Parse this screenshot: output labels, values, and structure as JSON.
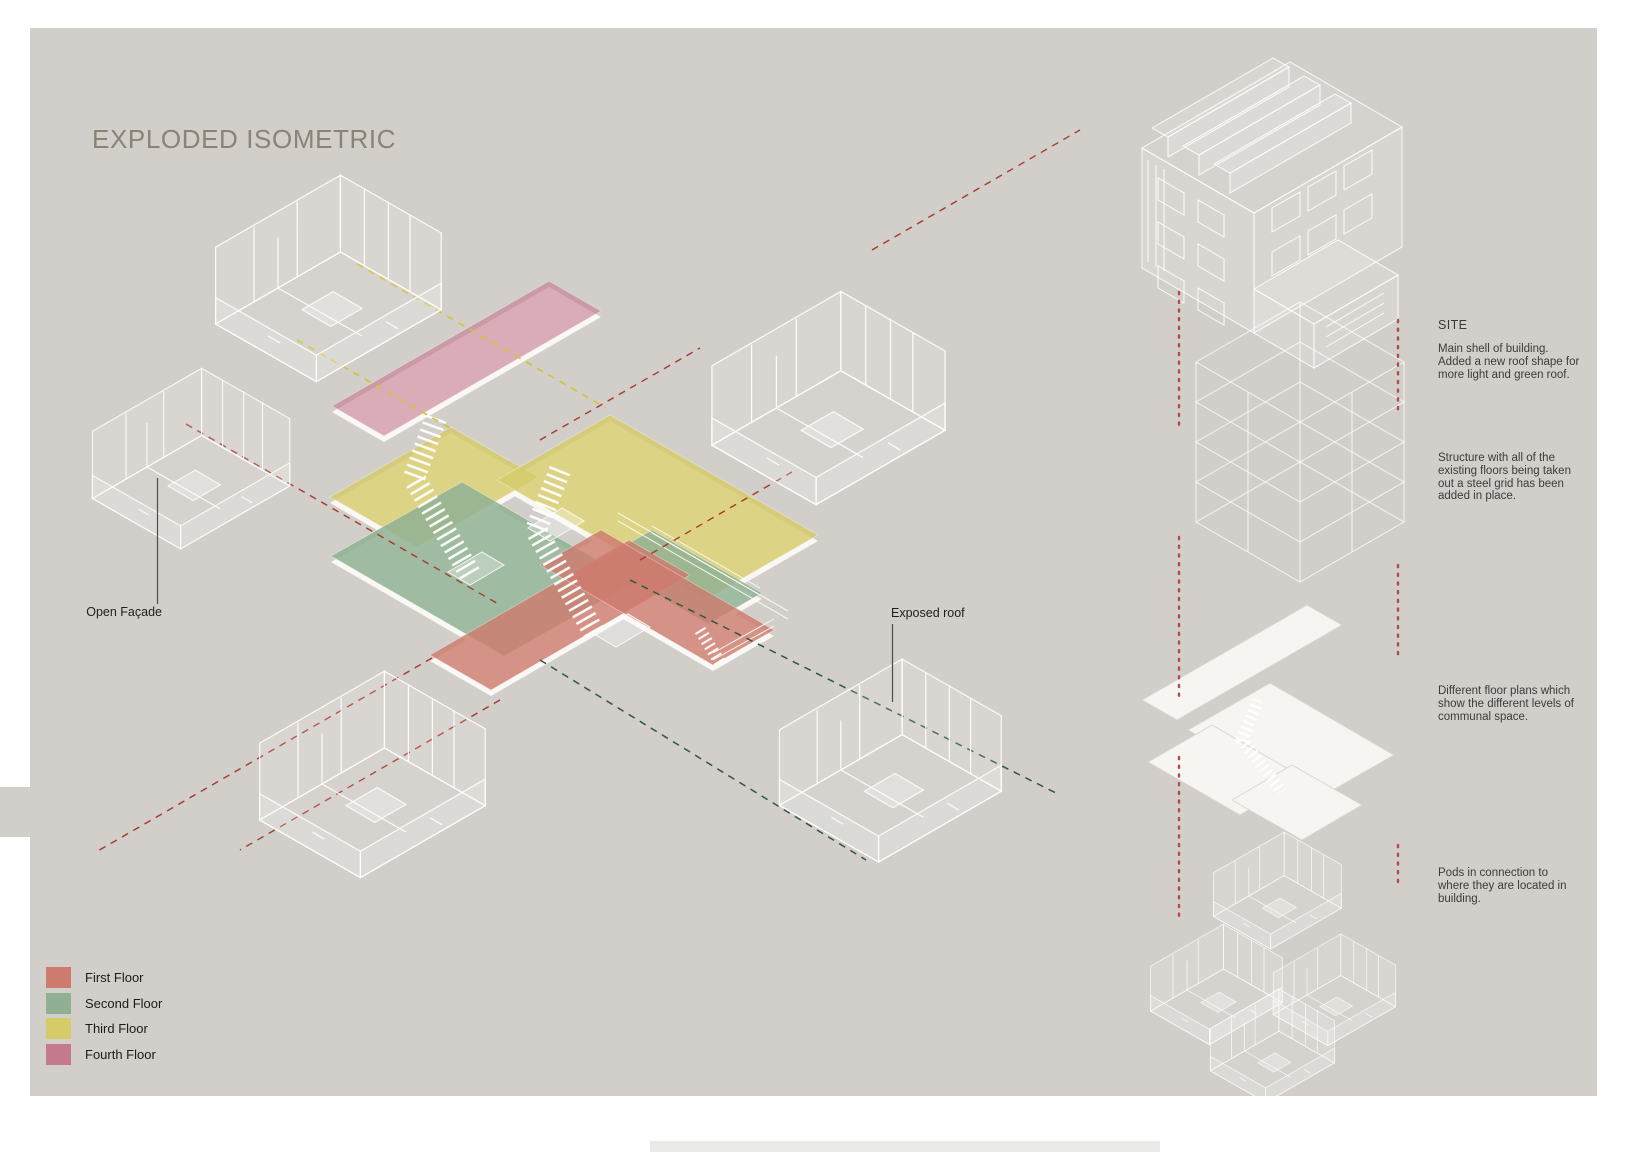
{
  "title": "EXPLODED ISOMETRIC",
  "labels": {
    "open_facade": "Open Façade",
    "exposed_roof": "Exposed roof"
  },
  "legend": {
    "items": [
      {
        "label": "First Floor",
        "color": "#cd7b6e",
        "swatch_style": "background:#cd7b6e"
      },
      {
        "label": "Second Floor",
        "color": "#8fb092",
        "swatch_style": "background:#8fb092"
      },
      {
        "label": "Third Floor",
        "color": "#d5cb68",
        "swatch_style": "background:#d5cb68"
      },
      {
        "label": "Fourth Floor",
        "color": "#c4798f",
        "swatch_style": "background:#c4798f"
      }
    ]
  },
  "annotations": {
    "site_heading": "SITE",
    "shell": "Main shell of building.\nAdded a new roof shape for\nmore light and green roof.",
    "structure": "Structure with all of the\nexisting floors being taken\nout a steel grid has been\nadded in place.",
    "floor_plans": "Different floor plans which\nshow the different levels of\ncommunal space.",
    "pods": "Pods in connection to\nwhere they are located in\nbuilding."
  },
  "colors": {
    "canvas_background": "#d2cec9",
    "title_text": "#8b8375",
    "first_floor": "#cd7b6e",
    "second_floor": "#8fb092",
    "third_floor": "#d5cb68",
    "fourth_floor": "#c4798f",
    "dashed_red": "#a8392e",
    "dashed_yellow": "#d2c433",
    "dashed_green": "#2f5840",
    "dotted_guide_red": "#b24a50"
  }
}
